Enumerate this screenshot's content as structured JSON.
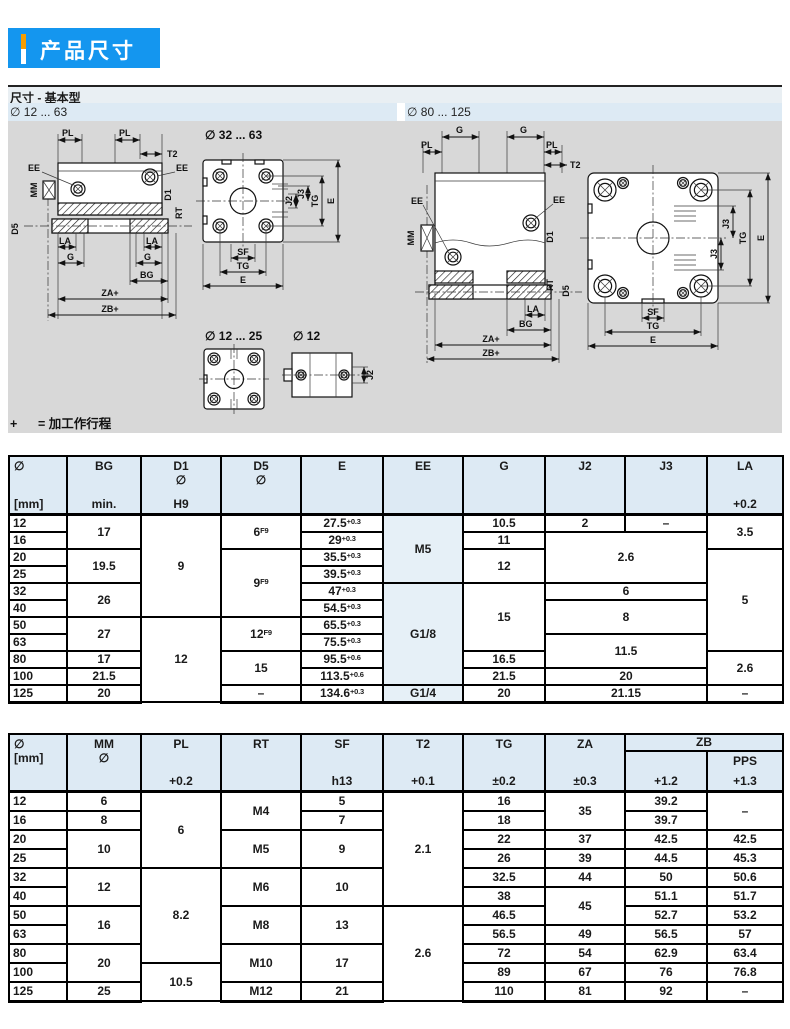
{
  "page": {
    "title": "产品尺寸"
  },
  "section": {
    "title": "尺寸 - 基本型",
    "range_left": "∅ 12 ... 63",
    "range_right": "∅ 80 ... 125",
    "label_mid": "∅ 32 ... 63",
    "label_tiny": "∅ 12 ... 25",
    "label_single": "∅ 12",
    "note_plus": "+",
    "note_text": "= 加工作行程"
  },
  "dim": {
    "pl": "PL",
    "t2": "T2",
    "ee": "EE",
    "mm": "MM",
    "d1": "D1",
    "rt": "RT",
    "d5": "D5",
    "la": "LA",
    "g": "G",
    "bg": "BG",
    "za": "ZA+",
    "zb": "ZB+",
    "sf": "SF",
    "tg": "TG",
    "e": "E",
    "j2": "J2",
    "j3": "J3"
  },
  "colors": {
    "brand_blue": "#1496ef",
    "accent_orange": "#f59d00",
    "band_blue": "#ddeaf4",
    "drawing_gray": "#d8d8d8",
    "table_header_blue": "#ddeaf4",
    "shade_blue": "#e6f0f7"
  },
  "table1": {
    "header": [
      {
        "l1": "∅",
        "l3": "[mm]",
        "align": "left"
      },
      {
        "l1": "BG",
        "l3": "min."
      },
      {
        "l1": "D1",
        "l2": "∅",
        "l3": "H9"
      },
      {
        "l1": "D5",
        "l2": "∅"
      },
      {
        "l1": "E"
      },
      {
        "l1": "EE"
      },
      {
        "l1": "G"
      },
      {
        "l1": "J2"
      },
      {
        "l1": "J3"
      },
      {
        "l1": "LA",
        "l3": "+0.2"
      }
    ],
    "rows": [
      [
        {
          "t": "12",
          "align": "left"
        },
        {
          "t": "17",
          "rs": 2
        },
        {
          "t": "9",
          "rs": 6
        },
        {
          "t": "6",
          "sup": "F9",
          "rs": 2
        },
        {
          "t": "27.5",
          "sup": "+0.3"
        },
        {
          "t": "M5",
          "rs": 4,
          "shade": true
        },
        {
          "t": "10.5"
        },
        {
          "t": "2"
        },
        {
          "t": "–"
        },
        {
          "t": "3.5",
          "rs": 2
        }
      ],
      [
        {
          "t": "16",
          "align": "left"
        },
        {
          "t": "29",
          "sup": "+0.3"
        },
        {
          "t": "11"
        },
        {
          "t": "2.6",
          "rs": 3,
          "cs": 2
        }
      ],
      [
        {
          "t": "20",
          "align": "left"
        },
        {
          "t": "19.5",
          "rs": 2
        },
        {
          "t": "9",
          "sup": "F9",
          "rs": 4
        },
        {
          "t": "35.5",
          "sup": "+0.3"
        },
        {
          "t": "12",
          "rs": 2
        },
        {
          "t": "5",
          "rs": 6
        }
      ],
      [
        {
          "t": "25",
          "align": "left"
        },
        {
          "t": "39.5",
          "sup": "+0.3"
        }
      ],
      [
        {
          "t": "32",
          "align": "left"
        },
        {
          "t": "26",
          "rs": 2
        },
        {
          "t": "47",
          "sup": "+0.3"
        },
        {
          "t": "G1/8",
          "rs": 6,
          "shade": true
        },
        {
          "t": "15",
          "rs": 4
        },
        {
          "t": "6",
          "cs": 2
        }
      ],
      [
        {
          "t": "40",
          "align": "left"
        },
        {
          "t": "54.5",
          "sup": "+0.3"
        },
        {
          "t": "8",
          "rs": 2,
          "cs": 2
        }
      ],
      [
        {
          "t": "50",
          "align": "left"
        },
        {
          "t": "27",
          "rs": 2
        },
        {
          "t": "12",
          "rs": 5
        },
        {
          "t": "12",
          "sup": "F9",
          "rs": 2
        },
        {
          "t": "65.5",
          "sup": "+0.3"
        }
      ],
      [
        {
          "t": "63",
          "align": "left"
        },
        {
          "t": "75.5",
          "sup": "+0.3"
        },
        {
          "t": "11.5",
          "rs": 2,
          "cs": 2
        }
      ],
      [
        {
          "t": "80",
          "align": "left"
        },
        {
          "t": "17"
        },
        {
          "t": "15",
          "rs": 2
        },
        {
          "t": "95.5",
          "sup": "+0.6"
        },
        {
          "t": "16.5"
        },
        {
          "t": "2.6",
          "rs": 2
        }
      ],
      [
        {
          "t": "100",
          "align": "left"
        },
        {
          "t": "21.5"
        },
        {
          "t": "113.5",
          "sup": "+0.6"
        },
        {
          "t": "21.5"
        },
        {
          "t": "20",
          "cs": 2
        }
      ],
      [
        {
          "t": "125",
          "align": "left"
        },
        {
          "t": "20"
        },
        {
          "t": "–"
        },
        {
          "t": "134.6",
          "sup": "+0.3"
        },
        {
          "t": "G1/4",
          "shade": true
        },
        {
          "t": "20"
        },
        {
          "t": "21.15",
          "cs": 2
        },
        {
          "t": "–"
        }
      ]
    ]
  },
  "table2": {
    "header": [
      {
        "l1": "∅",
        "l2": "[mm]",
        "align": "left"
      },
      {
        "l1": "MM",
        "l2": "∅"
      },
      {
        "l1": "PL",
        "l3": "+0.2"
      },
      {
        "l1": "RT"
      },
      {
        "l1": "SF",
        "l3": "h13"
      },
      {
        "l1": "T2",
        "l3": "+0.1"
      },
      {
        "l1": "TG",
        "l3": "±0.2"
      },
      {
        "l1": "ZA",
        "l3": "±0.3"
      },
      {
        "group": "ZB",
        "children": [
          {
            "l3": "+1.2"
          },
          {
            "l1": "PPS",
            "l3": "+1.3"
          }
        ]
      }
    ],
    "rows": [
      [
        {
          "t": "12",
          "align": "left"
        },
        {
          "t": "6"
        },
        {
          "t": "6",
          "rs": 4
        },
        {
          "t": "M4",
          "rs": 2
        },
        {
          "t": "5"
        },
        {
          "t": "2.1",
          "rs": 6
        },
        {
          "t": "16"
        },
        {
          "t": "35",
          "rs": 2
        },
        {
          "t": "39.2"
        },
        {
          "t": "–",
          "rs": 2
        }
      ],
      [
        {
          "t": "16",
          "align": "left"
        },
        {
          "t": "8"
        },
        {
          "t": "7"
        },
        {
          "t": "18"
        },
        {
          "t": "39.7"
        }
      ],
      [
        {
          "t": "20",
          "align": "left"
        },
        {
          "t": "10",
          "rs": 2
        },
        {
          "t": "M5",
          "rs": 2
        },
        {
          "t": "9",
          "rs": 2
        },
        {
          "t": "22"
        },
        {
          "t": "37"
        },
        {
          "t": "42.5"
        },
        {
          "t": "42.5"
        }
      ],
      [
        {
          "t": "25",
          "align": "left"
        },
        {
          "t": "26"
        },
        {
          "t": "39"
        },
        {
          "t": "44.5"
        },
        {
          "t": "45.3"
        }
      ],
      [
        {
          "t": "32",
          "align": "left"
        },
        {
          "t": "12",
          "rs": 2
        },
        {
          "t": "8.2",
          "rs": 5
        },
        {
          "t": "M6",
          "rs": 2
        },
        {
          "t": "10",
          "rs": 2
        },
        {
          "t": "32.5"
        },
        {
          "t": "44"
        },
        {
          "t": "50"
        },
        {
          "t": "50.6"
        }
      ],
      [
        {
          "t": "40",
          "align": "left"
        },
        {
          "t": "38"
        },
        {
          "t": "45",
          "rs": 2
        },
        {
          "t": "51.1"
        },
        {
          "t": "51.7"
        }
      ],
      [
        {
          "t": "50",
          "align": "left"
        },
        {
          "t": "16",
          "rs": 2
        },
        {
          "t": "M8",
          "rs": 2
        },
        {
          "t": "13",
          "rs": 2
        },
        {
          "t": "2.6",
          "rs": 5
        },
        {
          "t": "46.5"
        },
        {
          "t": "52.7"
        },
        {
          "t": "53.2"
        }
      ],
      [
        {
          "t": "63",
          "align": "left"
        },
        {
          "t": "56.5"
        },
        {
          "t": "49"
        },
        {
          "t": "56.5"
        },
        {
          "t": "57"
        }
      ],
      [
        {
          "t": "80",
          "align": "left"
        },
        {
          "t": "20",
          "rs": 2
        },
        {
          "t": "M10",
          "rs": 2
        },
        {
          "t": "17",
          "rs": 2
        },
        {
          "t": "72"
        },
        {
          "t": "54"
        },
        {
          "t": "62.9"
        },
        {
          "t": "63.4"
        }
      ],
      [
        {
          "t": "100",
          "align": "left"
        },
        {
          "t": "10.5",
          "rs": 2
        },
        {
          "t": "89"
        },
        {
          "t": "67"
        },
        {
          "t": "76"
        },
        {
          "t": "76.8"
        }
      ],
      [
        {
          "t": "125",
          "align": "left"
        },
        {
          "t": "25"
        },
        {
          "t": "M12"
        },
        {
          "t": "21"
        },
        {
          "t": "110"
        },
        {
          "t": "81"
        },
        {
          "t": "92"
        },
        {
          "t": "–"
        }
      ]
    ]
  }
}
